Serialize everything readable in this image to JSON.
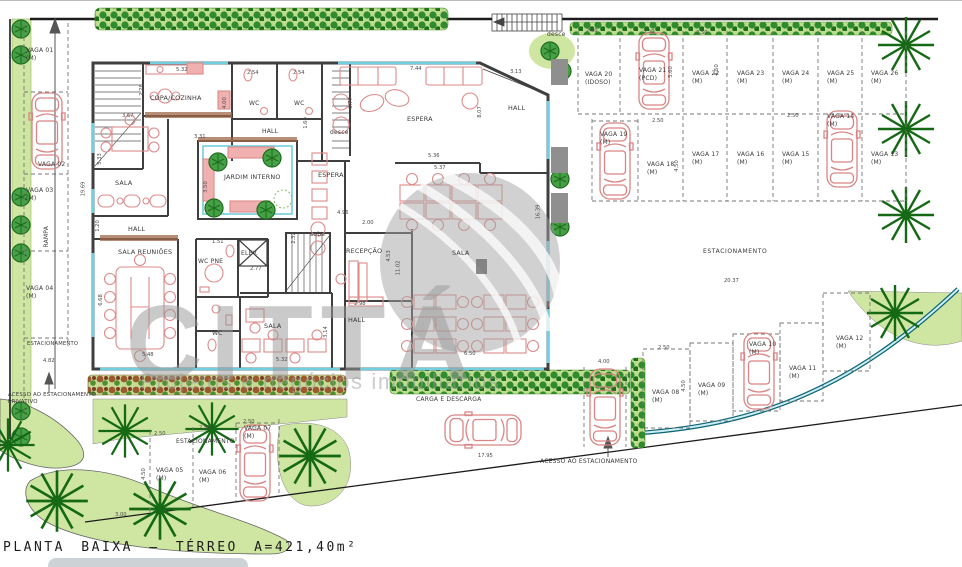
{
  "title": "PLANTA BAIXA – TÉRREO A=421,40m²",
  "watermark": {
    "brand": "CITTÁ",
    "tagline": "Projetos e negócios imobiliários"
  },
  "rooms": {
    "copa": "COPA/COZINHA",
    "wc1": "WC",
    "wc2": "WC",
    "wc3": "WC",
    "hall_top": "HALL",
    "hall_right": "HALL",
    "hall_center": "HALL",
    "hall_left": "HALL",
    "sala_left": "SALA",
    "sala_open": "SALA",
    "sala_small": "SALA",
    "sala_reunioes": "SALA REUNIÕES",
    "jardim": "JARDIM INTERNO",
    "espera_top": "ESPERA",
    "espera_mid": "ESPERA",
    "recepcao": "RECEPÇÃO",
    "wc_pne": "WC PNE",
    "elev": "ELEV.",
    "sobe": "sobe",
    "desce_int": "desce",
    "desce_ext": "desce"
  },
  "site": {
    "estacionamento_right": "ESTACIONAMENTO",
    "estacionamento_left": "ESTACIONAMENTO",
    "estacionamento_bottom": "ESTACIONAMENTO",
    "rampa": "RAMPA",
    "carga": "CARGA E DESCARGA",
    "acesso_privativo": "ACESSO AO ESTACIONAMENTO\nPRIVATIVO",
    "acesso": "ACESSO AO ESTACIONAMENTO"
  },
  "vagas": {
    "v01": "VAGA 01\n(M)",
    "v02": "VAGA 02",
    "v03": "VAGA 03\n(M)",
    "v04": "VAGA 04\n(M)",
    "v05": "VAGA 05\n(M)",
    "v06": "VAGA 06\n(M)",
    "v07": "VAGA 07\n(M)",
    "v08": "VAGA 08\n(M)",
    "v09": "VAGA 09\n(M)",
    "v10": "VAGA 10\n(M)",
    "v11": "VAGA 11\n(M)",
    "v12": "VAGA 12\n(M)",
    "v13": "VAGA 13\n(M)",
    "v14": "VAGA 14\n(M)",
    "v15": "VAGA 15\n(M)",
    "v16": "VAGA 16\n(M)",
    "v17": "VAGA 17\n(M)",
    "v18": "VAGA 18\n(M)",
    "v19": "VAGA 19\n(M)",
    "v20": "VAGA 20\n(IDOSO)",
    "v21": "VAGA 21\n(PCD)",
    "v22": "VAGA 22\n(M)",
    "v23": "VAGA 23\n(M)",
    "v24": "VAGA 24\n(M)",
    "v25": "VAGA 25\n(M)",
    "v26": "VAGA 26\n(M)"
  },
  "dims": {
    "d120": "1.20",
    "d151": "1.51",
    "d160": "1.60",
    "d200": "2.00",
    "d226": "2.26",
    "d232": "2.32",
    "d250": "2.50",
    "d254": "2.54",
    "d277": "2.77",
    "d298": "2.98",
    "d300": "3.00",
    "d313": "3.13",
    "d314": "3.14",
    "d331": "3.31",
    "d333": "3.33",
    "d350": "3.50",
    "d367": "3.67",
    "d377": "3.77",
    "d400": "4.00",
    "d450": "4.50",
    "d453": "4.53",
    "d482": "4.82",
    "d496": "4.96",
    "d532": "5.32",
    "d533": "5.33",
    "d536": "5.36",
    "d537": "5.37",
    "d548": "5.48",
    "d560": "5.60",
    "d650": "6.50",
    "d668": "6.68",
    "d744": "7.44",
    "d807": "8.07",
    "d1102": "11.02",
    "d1639": "16.39",
    "d1795": "17.95",
    "d1969": "19.69",
    "d2037": "20.37"
  }
}
